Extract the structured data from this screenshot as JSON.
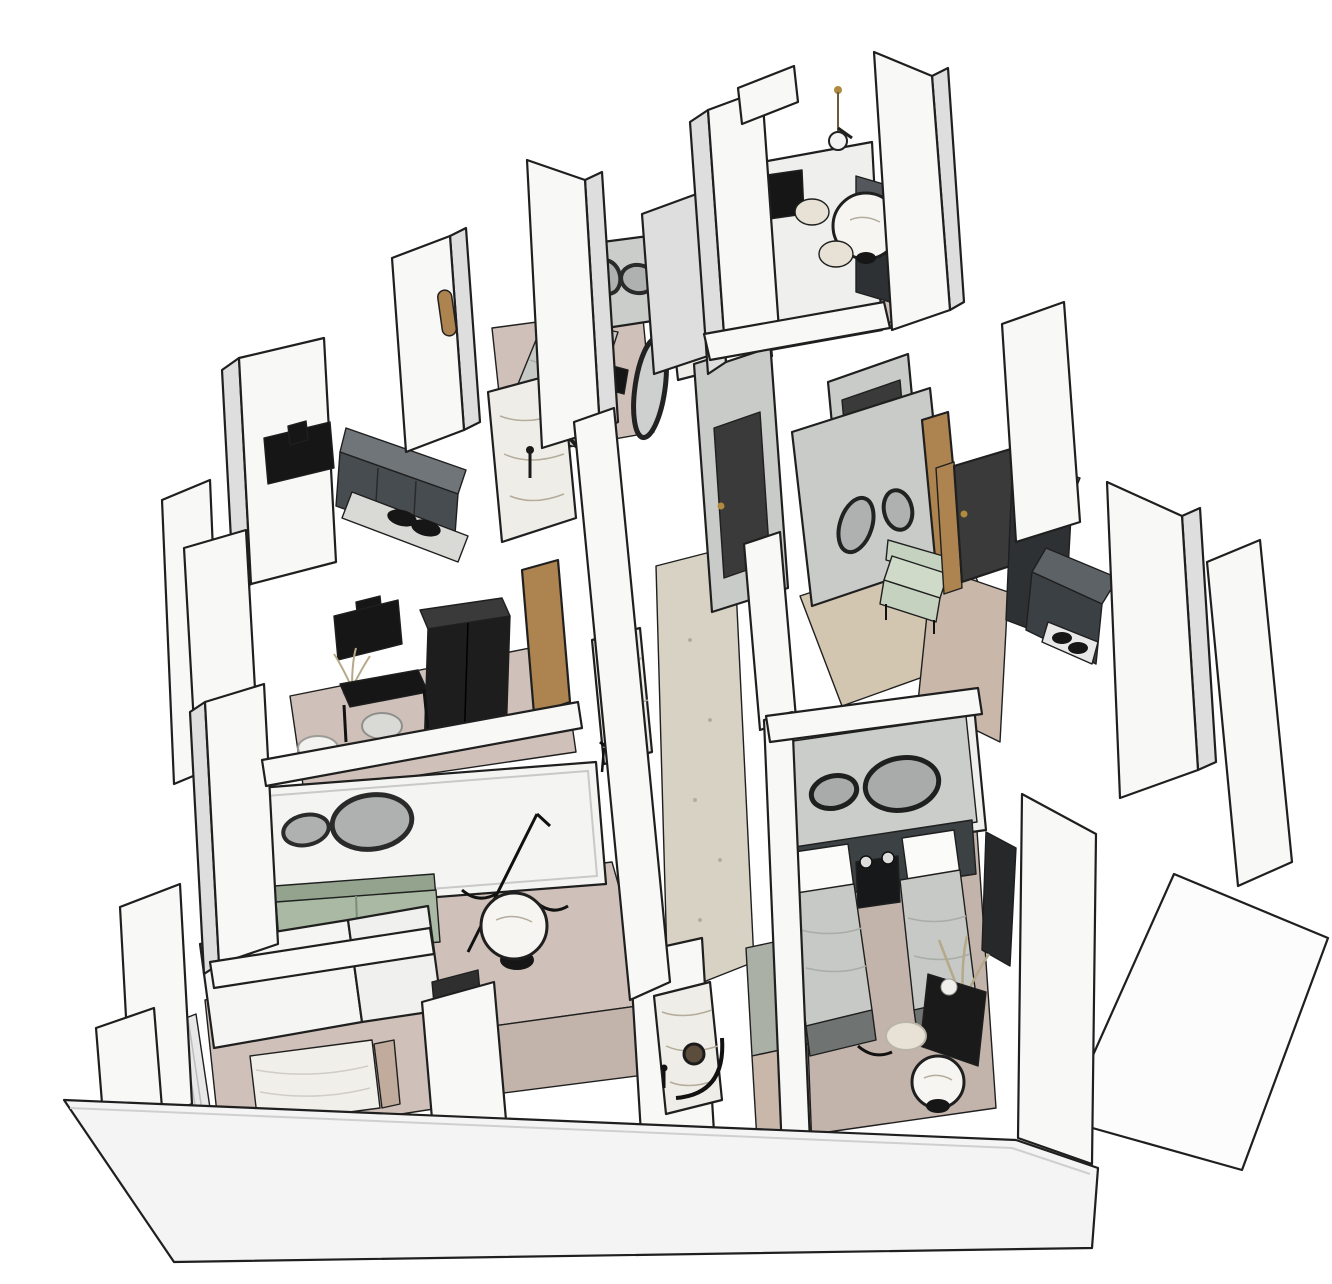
{
  "page": {
    "background": "#ffffff",
    "view": "isometric-dollhouse-3d-floorplan",
    "style": "sketchup-white-model-black-edges"
  },
  "palette": {
    "background": "#ffffff",
    "outline": "#1f1f1f",
    "wallFace": "#f8f8f7",
    "wallSide": "#dedede",
    "wallShadow": "#a9a9a9",
    "wallInner": "#efefee",
    "interiorGray": "#c9cbc9",
    "panelGray": "#cbcdca",
    "accentDark": "#3c4144",
    "furnitureBlack": "#161616",
    "cabinetDark": "#2e3134",
    "cabinetMid": "#54585c",
    "cabinetFront": "#474c51",
    "mirrorGray": "#aeb1b0",
    "sofaGreen": "#a9b9a3",
    "sofaGreenDark": "#93a38e",
    "benchGreen": "#c4d2bf",
    "woodTan": "#ad8350",
    "doorDark": "#3a3a3a",
    "handleGold": "#b08a3e",
    "floorWoodPink": "#cfc1b9",
    "floorWood": "#c9b8aa",
    "floorBedroom": "#c3b4ab",
    "floorCorridor": "#d8d2c5",
    "floorEntry": "#d2c6b0",
    "floorTile": "#aab0a6",
    "marbleBase": "#efede7",
    "marbleVein": "#b4ac9c",
    "beddingGray": "#c6c9c5",
    "beddingFoot": "#6f7472",
    "pillowWhite": "#fbfbfa",
    "tableMarble": "#f6f5f2",
    "poufCream": "#e7e2d5",
    "plantTan": "#b5a989",
    "curtain": "#e8e8e8",
    "curtainStripe": "#bdbdbd"
  },
  "scene": {
    "projection": "axonometric top-down dollhouse cutaway",
    "rooms": [
      {
        "name": "dining-nook",
        "position": "top",
        "furniture": [
          "pendant-lamp",
          "round-marble-table",
          "cream-poufs",
          "wall-tv",
          "tall-dark-cabinet"
        ]
      },
      {
        "name": "bedroom-small",
        "position": "upper-middle-left",
        "furniture": [
          "double-bed",
          "organic-wall-mirrors",
          "leaning-oval-mirror",
          "dark-side-table"
        ]
      },
      {
        "name": "shower-room-marble",
        "position": "upper-middle",
        "furniture": [
          "marble-walls",
          "curved-glass-shower"
        ]
      },
      {
        "name": "kitchen-left",
        "position": "middle-left",
        "furniture": [
          "wall-tv",
          "dark-upper-cabinets",
          "cooktop-counter"
        ]
      },
      {
        "name": "study",
        "position": "center-left",
        "furniture": [
          "wall-tv",
          "black-wardrobe",
          "black-desk",
          "desk-chair",
          "plant",
          "wood-door"
        ]
      },
      {
        "name": "living-room",
        "position": "lower-left",
        "furniture": [
          "decor-panel-organic-mirrors",
          "sage-green-sofa",
          "round-marble-coffee-table",
          "floor-lamp",
          "black-chairs",
          "curtains"
        ]
      },
      {
        "name": "bedroom-left",
        "position": "bottom-left",
        "furniture": [
          "double-bed-white-duvet",
          "curtains",
          "black-console",
          "dark-doorway"
        ]
      },
      {
        "name": "bathroom-small",
        "position": "bottom-middle",
        "furniture": [
          "marble-panel",
          "round-mirror",
          "curved-shower-screen",
          "tile-floor"
        ]
      },
      {
        "name": "hallway",
        "position": "center",
        "furniture": [
          "terrazzo-floor",
          "dark-door-gold-handle",
          "marble-vanity-round-mirror"
        ]
      },
      {
        "name": "entry",
        "position": "center-right",
        "furniture": [
          "organic-mirrors",
          "pale-green-bench",
          "wood-panel",
          "dark-entry-door"
        ]
      },
      {
        "name": "kitchen-right",
        "position": "right",
        "furniture": [
          "dark-door-wood-frame",
          "dark-fridge",
          "dark-counter-cooktop"
        ]
      },
      {
        "name": "bedroom-twin",
        "position": "lower-right",
        "furniture": [
          "twin-beds",
          "dark-headboard-wall",
          "organic-mirrors",
          "shared-nightstand",
          "wall-sconces",
          "plant",
          "black-desk",
          "round-marble-side-table",
          "cream-pouf",
          "dark-wardrobe"
        ]
      },
      {
        "name": "balcony-slab",
        "position": "bottom-right",
        "furniture": []
      }
    ]
  }
}
